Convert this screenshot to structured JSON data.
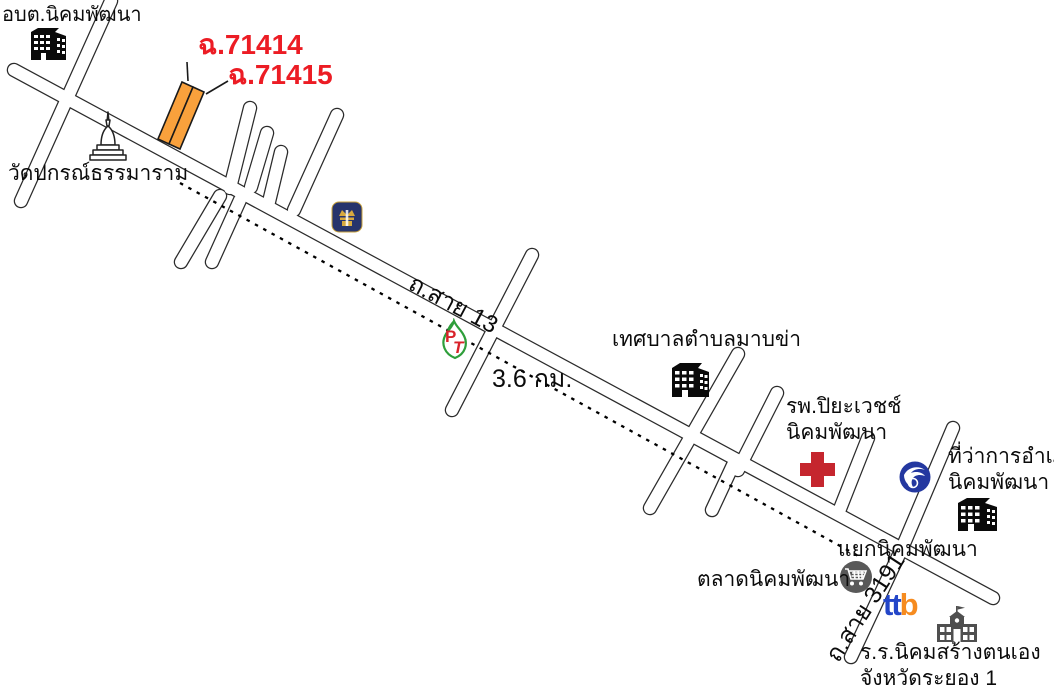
{
  "map": {
    "parcel_labels": {
      "lot1": "ฉ.71414",
      "lot2": "ฉ.71415"
    },
    "roads": {
      "route13": "ถ.สาย 13",
      "route3191": "ถ.สาย 3191"
    },
    "distance_note": "3.6 กม.",
    "landmarks": {
      "subdistrict_office": "อบต.นิคมพัฒนา",
      "temple": "วัดปกรณ์ธรรมาราม",
      "municipality": "เทศบาลตำบลมาบข่า",
      "hospital_line1": "รพ.ปิยะเวชช์",
      "hospital_line2": "นิคมพัฒนา",
      "district_office_line1": "ที่ว่าการอำเภอ",
      "district_office_line2": "นิคมพัฒนา",
      "intersection": "แยกนิคมพัฒนา",
      "market": "ตลาดนิคมพัฒนา",
      "school_line1": "ร.ร.นิคมสร้างตนเอง",
      "school_line2": "จังหวัดระยอง 1"
    },
    "logos": {
      "ttb_tt": "tt",
      "ttb_b": "b",
      "pt_p": "P",
      "pt_t": "T"
    },
    "icons": [
      "office-building-icon",
      "temple-stupa-icon",
      "bangkok-bank-icon",
      "pt-gas-station-icon",
      "municipality-building-icon",
      "hospital-cross-icon",
      "krungthai-bank-icon",
      "district-office-building-icon",
      "market-cart-icon",
      "ttb-bank-logo",
      "school-icon"
    ],
    "colors": {
      "parcel_orange": "#F9A13C",
      "label_red": "#EC1C24",
      "hospital_cross_red": "#C5262E",
      "road_outline": "#1a1a1a",
      "road_fill": "#ffffff",
      "ttb_blue": "#2346C8",
      "ttb_orange": "#F68B1F",
      "pt_green": "#2E9E3A",
      "pt_red": "#D8232A",
      "bbl_navy": "#27346C",
      "bbl_gold": "#D8A93F",
      "ktb_blue": "#2438A0",
      "market_gray": "#595959",
      "school_gray": "#4F4F4F",
      "building_black": "#0a0a0a"
    }
  }
}
